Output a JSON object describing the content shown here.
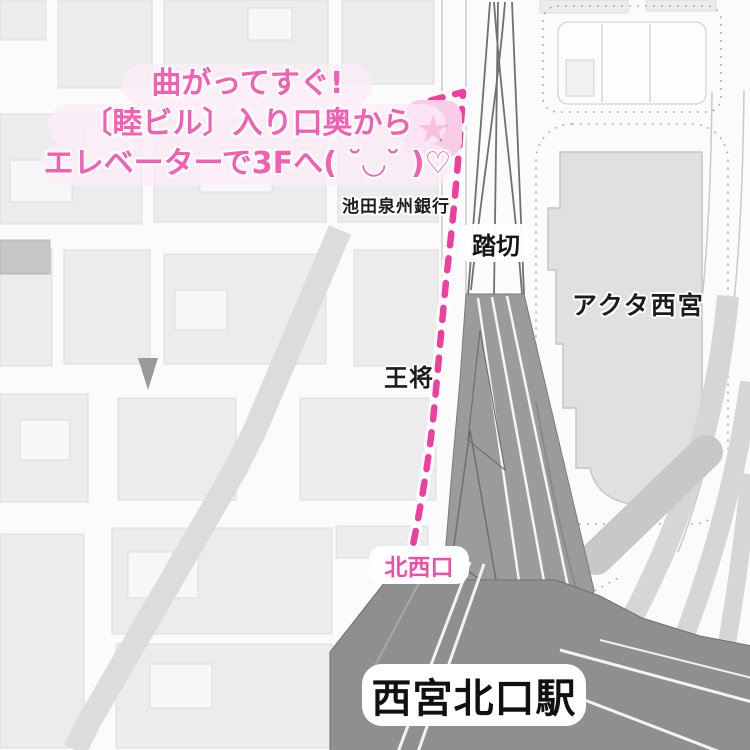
{
  "map": {
    "annotation": {
      "line1": "曲がってすぐ!",
      "line2": "〔睦ビル〕入り口奥から",
      "line3": "エレベーターで3Fへ( ˘◡˘ )♡"
    },
    "pois": {
      "bank": "池田泉州銀行",
      "crossing": "踏切",
      "acta": "アクタ西宮",
      "ohsho": "王将",
      "northwest_exit": "北西口",
      "station": "西宮北口駅"
    },
    "marker": {
      "glyph": "★"
    },
    "colors": {
      "annotation_pink": "#f25fb3",
      "route_pink": "#ee3f9e",
      "star": "#e44fa8",
      "star_bg": "#f8cce7",
      "exit_label_pink": "#ee4fa6",
      "station_gray": "#8f8f8f",
      "rail_fan_gray": "#9b9b9b",
      "block_gray": "#ececec",
      "tinted_road_gray": "#dcdcdc"
    }
  }
}
